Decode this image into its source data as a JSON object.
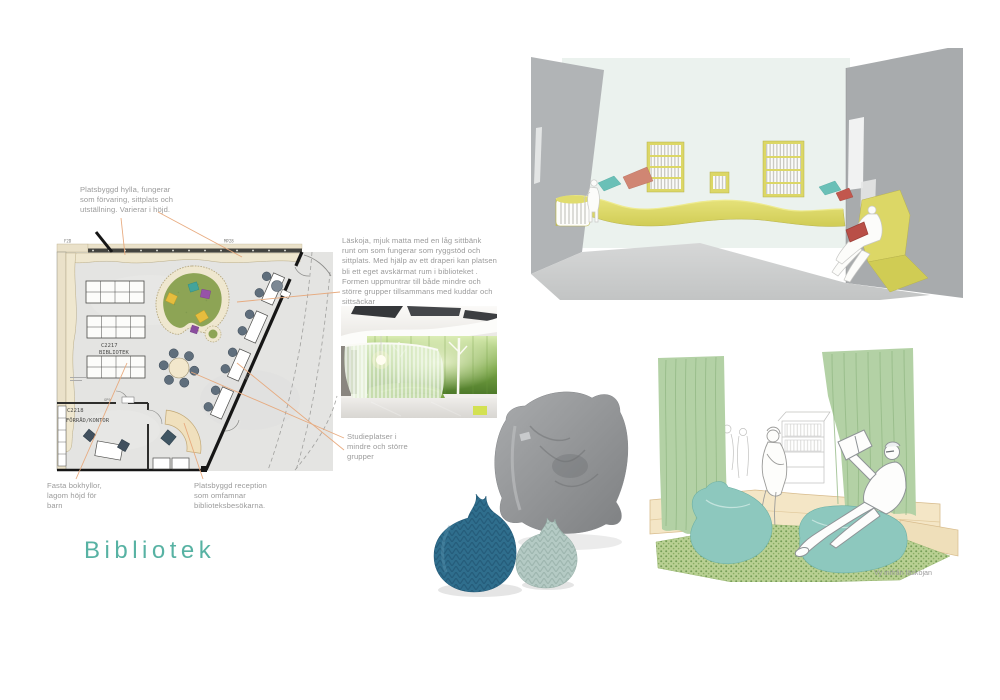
{
  "page": {
    "width": 1000,
    "height": 700,
    "background": "#ffffff"
  },
  "title": {
    "text": "Bibliotek",
    "color": "#57b2a3"
  },
  "annotations": {
    "platsbyggd_hylla": "Platsbyggd hylla, fungerar\nsom förvaring, sittplats och\nutställning. Varierar i höjd.",
    "laskoja": "Läskoja, mjuk matta med en låg sittbänk\nrunt om som fungerar som ryggstöd och\nsittplats. Med hjälp av ett draperi kan platsen\nbli ett eget avskärmat rum i biblioteket .\nFormen uppmuntrar till både mindre och\nstörre grupper tillsammans med kuddar och\nsittsäckar",
    "studieplatser": "Studieplatser i\nmindre och större\ngrupper",
    "fasta_bokhyllor": "Fasta bokhyllor,\nlagom höjd för\nbarn",
    "reception": "Platsbyggd reception\nsom omfamnar\nbiblioteksbesökarna."
  },
  "floor_plan": {
    "labels": {
      "room1_code": "C2217",
      "room1_name": "BIBLIOTEK",
      "room2_code": "C2218",
      "room2_name": "FÖRRÅD/KONTOR",
      "wall_top_left": "F2D",
      "wall_top_right": "MP28",
      "door": "GP9",
      "wall_diagonal": "MP1"
    }
  },
  "captions": {
    "laskoja_view": "Vy inifrån läskojan"
  },
  "colors": {
    "accent_teal": "#57b2a3",
    "leader_line": "#e7a87b",
    "annotation_text": "#9b9b9b",
    "laskoja_green": "#8da455",
    "bench_yellow": "#dcd766",
    "curtain_green": "#b3d1a5",
    "beanbag_teal": "#8dc8be",
    "pouf_blue": "#2f6e8d",
    "pouf_mint": "#b4cac4",
    "plan_wall_beige": "#eae1c9"
  }
}
